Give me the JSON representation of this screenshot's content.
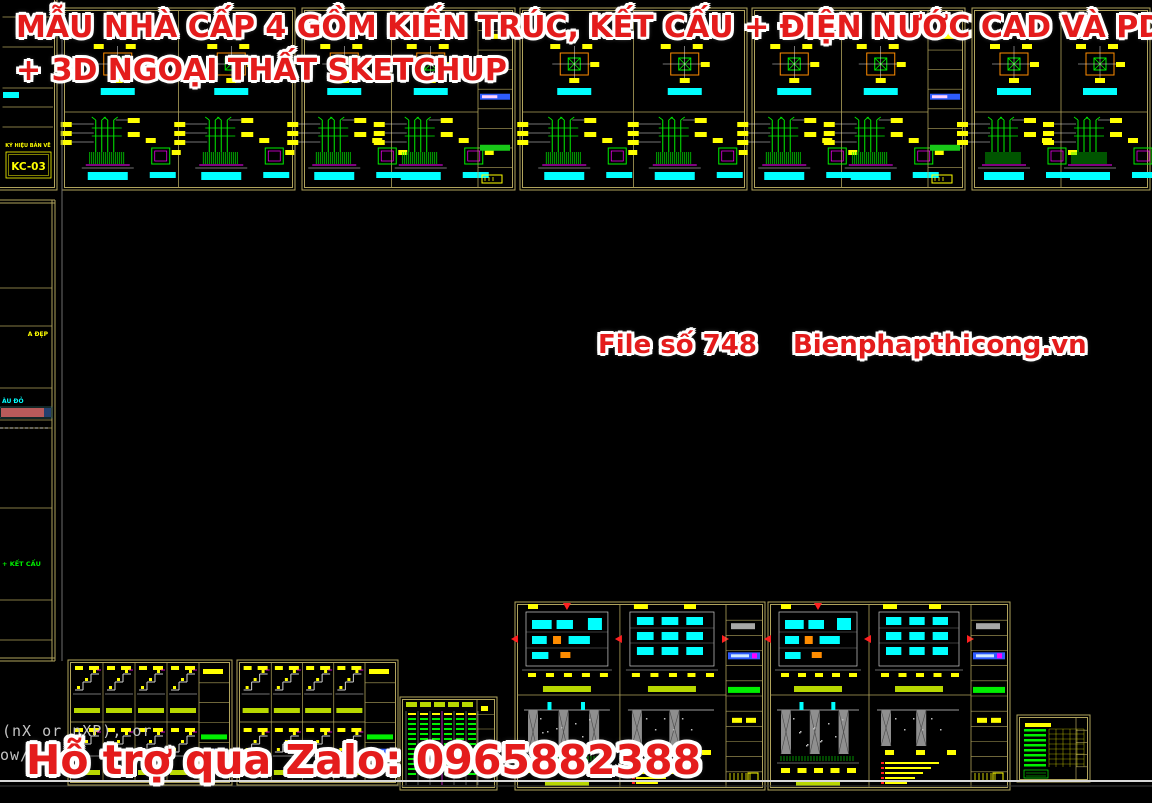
{
  "overlay": {
    "title_line1": "MẪU NHÀ CẤP 4 GỒM KIẾN TRÚC, KẾT CẤU + ĐIỆN NƯỚC CAD VÀ PDF",
    "title_line2": "+ 3D NGOẠI THẤT SKETCHUP",
    "file_label": "File số 748",
    "site_label": "Bienphapthicong.vn",
    "support_label": "Hỗ trợ qua Zalo: 0965882388",
    "text_color": "#e41c1c",
    "outline_color": "#ffffff"
  },
  "command_line": {
    "line1": "(nX or nXP), or",
    "line2": "ow/",
    "color": "#c4c4c4"
  },
  "left_top_block": {
    "label": "KÝ HIỆU BẢN VẼ",
    "code": "KC-03"
  },
  "left_strip_texts": {
    "yellow_text": "A ĐẸP",
    "cyan_text": "ÀU ĐỎ",
    "green_text": "+ KẾT CẤU"
  },
  "palette": {
    "bg": "#000000",
    "border": "#b0a35c",
    "green": "#00ef00",
    "lgreen": "#b8d800",
    "yellow": "#ffff00",
    "cyan": "#00ffff",
    "magenta": "#ff00ff",
    "orange": "#ff8c00",
    "white": "#e8e8e8",
    "gray": "#8f8f8f",
    "red": "#ff2020",
    "blue": "#2e5cff",
    "pinkbar": "#b85a5a"
  },
  "canvas": {
    "top_strip": {
      "y": 8,
      "h": 182,
      "split": 112,
      "sheets": [
        {
          "x": 62,
          "w": 233,
          "strip": false
        },
        {
          "x": 302,
          "w": 213,
          "strip": true
        },
        {
          "x": 520,
          "w": 227,
          "strip": false
        },
        {
          "x": 752,
          "w": 213,
          "strip": true
        },
        {
          "x": 972,
          "w": 178,
          "strip": false
        }
      ]
    },
    "left_block": {
      "x": -4,
      "y": -6,
      "w": 61,
      "h": 196
    },
    "left_strip": {
      "x": 0,
      "y": 200,
      "w": 55,
      "h": 461
    },
    "stairs_sheets": [
      {
        "x": 68,
        "w": 164
      },
      {
        "x": 237,
        "w": 161
      }
    ],
    "stairs_y": 660,
    "stairs_h": 125,
    "table_sheet": {
      "x": 400,
      "y": 697,
      "w": 97,
      "h": 93
    },
    "tank_sheets": [
      {
        "x": 515,
        "w": 250
      },
      {
        "x": 768,
        "w": 242
      }
    ],
    "tanks_y": 602,
    "tanks_h": 188,
    "small_table": {
      "x": 1017,
      "y": 715,
      "w": 73,
      "h": 67
    },
    "gray_vline_x": 62,
    "bottom_line_y": 781
  }
}
